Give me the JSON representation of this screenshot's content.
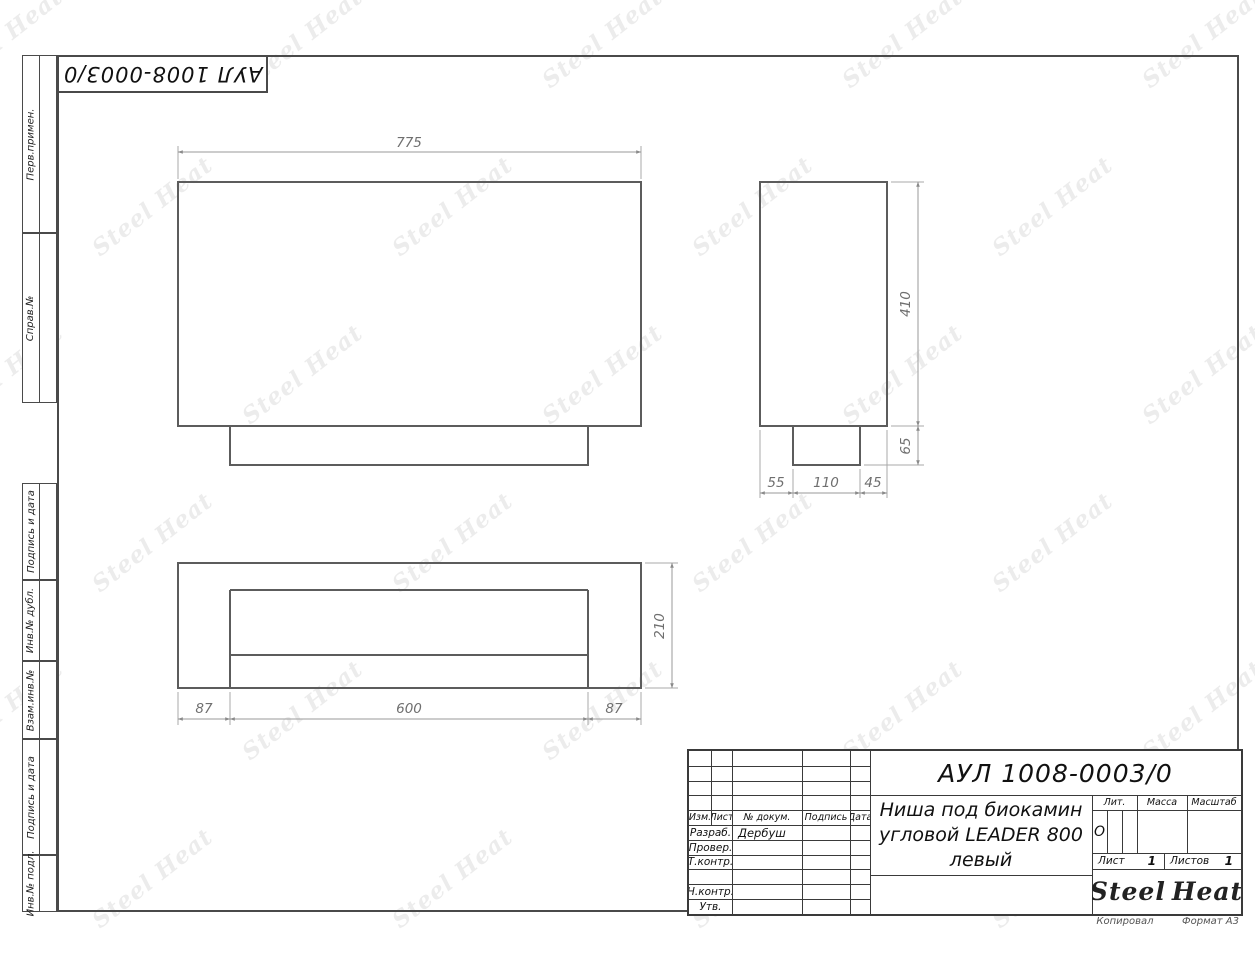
{
  "page": {
    "watermark_text": "Steel Heat",
    "footer_left": "Копировал",
    "footer_right": "Формат А3"
  },
  "top_stamp": {
    "doc_number": "АУЛ 1008-0003/0"
  },
  "sidebar": {
    "items": [
      {
        "label": "Перв.примен."
      },
      {
        "label": "Справ.№"
      },
      {
        "label": "Подпись и дата"
      },
      {
        "label": "Инв.№ дубл."
      },
      {
        "label": "Взам.инв.№"
      },
      {
        "label": "Подпись и дата"
      },
      {
        "label": "Инв.№ подл."
      }
    ]
  },
  "drawing": {
    "front_view": {
      "width": "775"
    },
    "side_view": {
      "height": "410",
      "base_height": "65",
      "bottom_left": "55",
      "bottom_center": "110",
      "bottom_right": "45"
    },
    "plan_view": {
      "depth": "210",
      "left_margin": "87",
      "opening": "600",
      "right_margin": "87"
    }
  },
  "title_block": {
    "doc_number": "АУЛ 1008-0003/0",
    "name_line1": "Ниша под биокамин",
    "name_line2": "угловой LEADER 800",
    "name_line3": "левый",
    "cols": {
      "izm": "Изм.",
      "list": "Лист",
      "doc": "№ докум.",
      "podpis": "Подпись",
      "data": "Дата"
    },
    "rows": {
      "razrab_label": "Разраб.",
      "razrab_value": "Дербуш",
      "prover_label": "Провер.",
      "tkontr_label": "Т.контр.",
      "nkontr_label": "Н.контр.",
      "utv_label": "Утв."
    },
    "lit_label": "Лит.",
    "lit_value": "О",
    "massa_label": "Масса",
    "masshtab_label": "Масштаб",
    "list_label": "Лист",
    "list_value": "1",
    "listov_label": "Листов",
    "listov_value": "1",
    "logo_left": "Steel",
    "logo_right": "Heat",
    "flame_color": "#e31e24"
  }
}
